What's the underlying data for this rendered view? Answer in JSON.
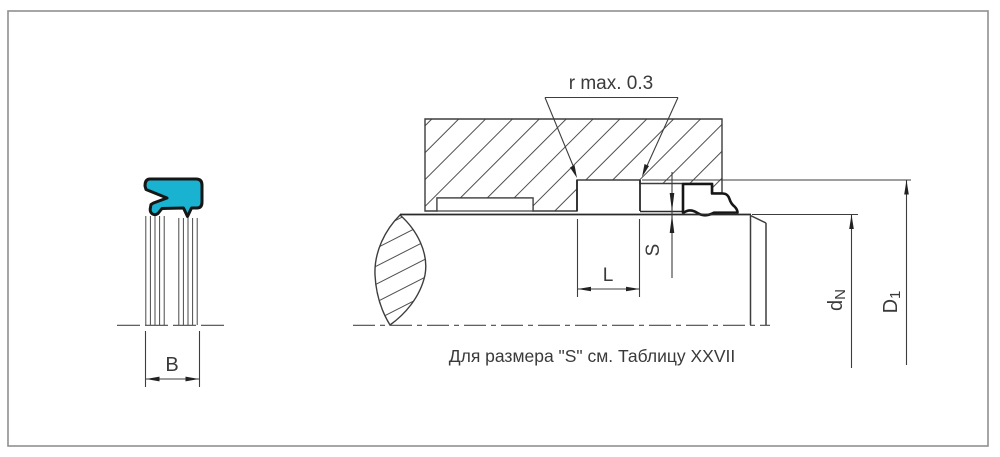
{
  "drawing": {
    "title": "Rod wiper seal installation drawing",
    "caption": "Для размера \"S\" см. Таблицу XXVII",
    "radius_note": "r  max. 0.3",
    "dimensions": {
      "seal_width": {
        "label": "B"
      },
      "groove_length": {
        "label": "L"
      },
      "radial_gap": {
        "label": "S"
      },
      "rod_diameter": {
        "base": "d",
        "sub": "N"
      },
      "bore_diameter": {
        "base": "D",
        "sub": "1"
      }
    },
    "colors": {
      "seal_fill": "#19b2d0",
      "outline_thick": "#161616",
      "line": "#3d3d3d",
      "hatch": "#4f4f4f",
      "text": "#3a3a3a",
      "border": "#8f8f8f"
    }
  }
}
